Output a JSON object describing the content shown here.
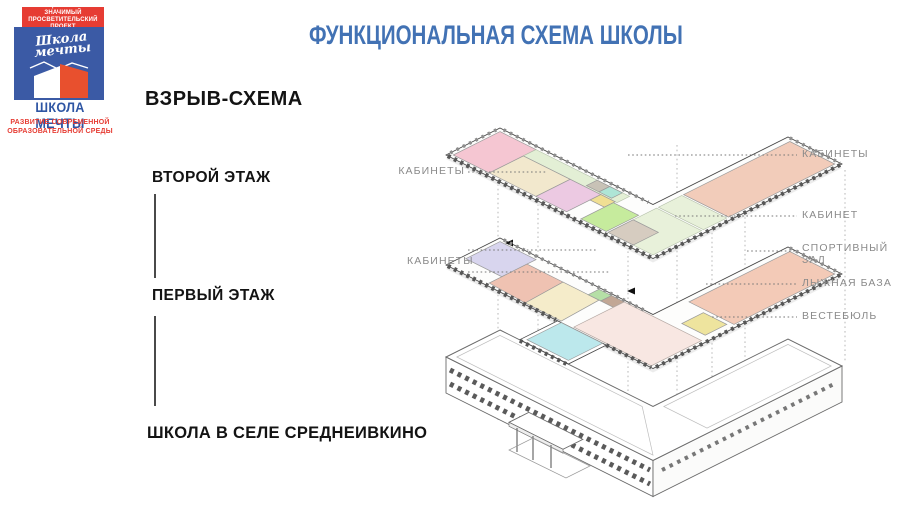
{
  "logo": {
    "banner_line1": "ОБЩЕСТВЕННО ЗНАЧИМЫЙ",
    "banner_line2": "ПРОСВЕТИТЕЛЬСКИЙ ПРОЕКТ",
    "script_line1": "Школа",
    "script_line2": "мечты",
    "name": "ШКОЛА МЕЧТЫ",
    "tagline_line1": "РАЗВИТИЕ СОВРЕМЕННОЙ",
    "tagline_line2": "ОБРАЗОВАТЕЛЬНОЙ СРЕДЫ"
  },
  "header": {
    "title": "ФУНКЦИОНАЛЬНАЯ СХЕМА ШКОЛЫ"
  },
  "left_panel": {
    "heading": "ВЗРЫВ-СХЕМА",
    "floor2": "ВТОРОЙ ЭТАЖ",
    "floor1": "ПЕРВЫЙ ЭТАЖ",
    "caption": "ШКОЛА В СЕЛЕ СРЕДНЕИВКИНО"
  },
  "diagram_labels": {
    "left_cabinets_2f": "КАБИНЕТЫ",
    "left_cabinets_1f": "КАБИНЕТЫ",
    "right_cabinets": "КАБИНЕТЫ",
    "right_cabinet": "КАБИНЕТ",
    "right_sport_line1": "СПОРТИВНЫЙ",
    "right_sport_line2": "ЗАЛ",
    "right_ski": "ЛЫЖНАЯ БАЗА",
    "right_vestibule": "ВЕСТЕБЮЛЬ"
  },
  "colors": {
    "title_blue": "#4272b4",
    "logo_red": "#e63c33",
    "logo_blue": "#3b5aa5",
    "logo_house_red": "#e8502e",
    "logo_name_blue": "#2e55a3",
    "f2_pink": "#f5c6d2",
    "f2_cream": "#f2e8cd",
    "f2_violet": "#ecc9e2",
    "f2_green": "#c6eb9d",
    "f2_corridor": "#e3efd5",
    "f2_gray": "#c8c2b6",
    "f2_teal": "#aee5d6",
    "f2_yellow": "#f0df93",
    "f2_junction": "#e8f1da",
    "f2_tan": "#d6ccc0",
    "f2_wing_salmon": "#f2ccba",
    "f2_wing_rooms": "#e8f1da",
    "f1_lavender": "#d8d5ee",
    "f1_salmon": "#efc2b2",
    "f1_cream": "#f5ecca",
    "f1_green": "#b5dfa6",
    "f1_brown": "#c2a795",
    "f1_hall": "#f8e7e2",
    "f1_cyan": "#bce8ec",
    "f1_yellow": "#eee49e",
    "f1_sport": "#f3cab7"
  }
}
